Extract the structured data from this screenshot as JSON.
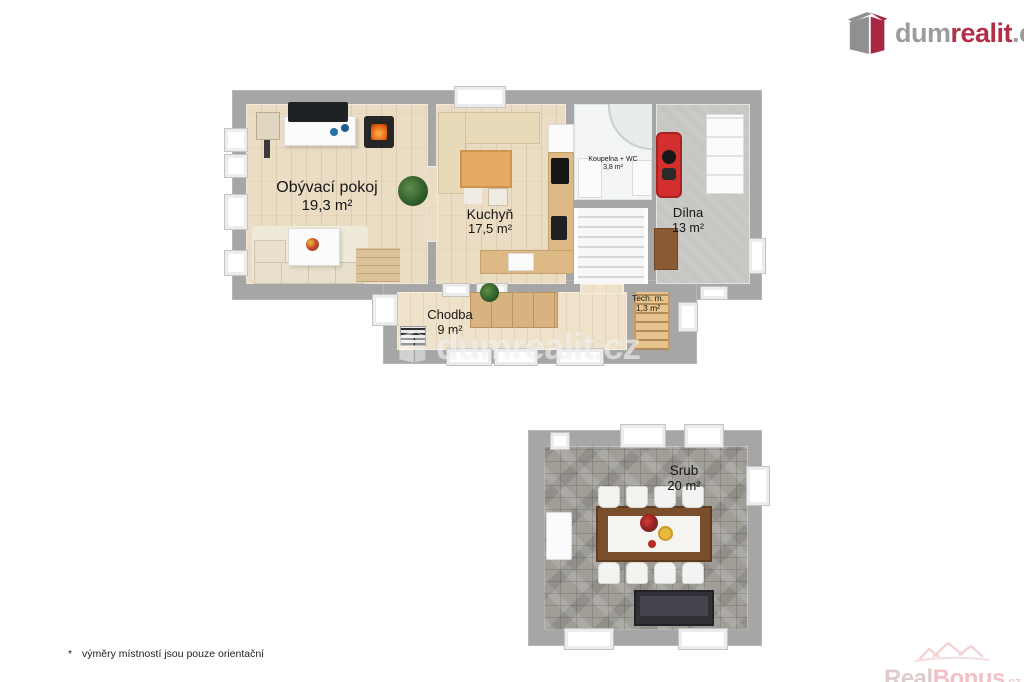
{
  "logo": {
    "part1": "dum",
    "part2": "realit",
    "part3": ".cz"
  },
  "center_watermark": {
    "text": "dumrealit.cz"
  },
  "bottom_watermark": {
    "part1": "Real",
    "part2": "Bonus",
    "part3": ".cz"
  },
  "footnote": {
    "marker": "*",
    "text": "výměry místností jsou pouze orientační"
  },
  "plans": {
    "main": {
      "rooms": {
        "living": {
          "name": "Obývací pokoj",
          "area": "19,3 m²"
        },
        "kitchen": {
          "name": "Kuchyň",
          "area": "17,5 m²"
        },
        "bathroom": {
          "name": "Koupelna + WC",
          "area": "3,8 m²"
        },
        "workshop": {
          "name": "Dílna",
          "area": "13 m²"
        },
        "hallway": {
          "name": "Chodba",
          "area": "9 m²"
        },
        "tech": {
          "name": "Tech. m.",
          "area": "1,3 m²"
        }
      }
    },
    "cabin": {
      "rooms": {
        "srub": {
          "name": "Srub",
          "area": "20 m²"
        }
      }
    }
  },
  "colors": {
    "brand_gray": "#9c9c9c",
    "brand_red": "#b13048",
    "wall_gray": "#a6a6a6",
    "realbonus_pink": "#f1b6ba"
  }
}
